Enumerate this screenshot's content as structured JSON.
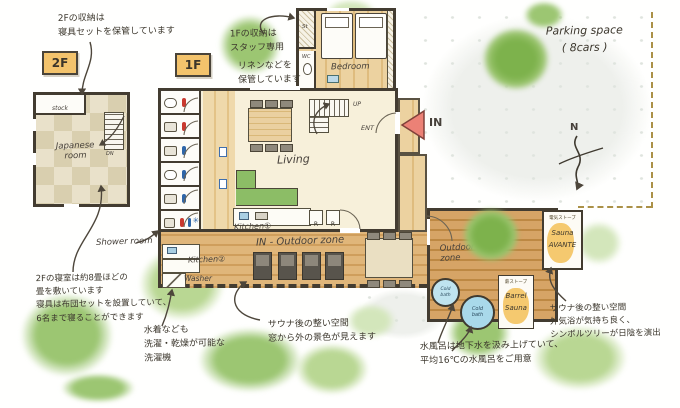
{
  "colors": {
    "wall": "#433c31",
    "ink": "#3c372d",
    "wood": "#dfbc7e",
    "deck": "#cf9e5c",
    "tatami_a": "#e9e1ca",
    "tatami_b": "#d9cfaf",
    "tag_orange": "#f3c36c",
    "sauna_orange": "#f5c96f",
    "tree_green": "#7db24c",
    "sofa_green": "#8cbd66",
    "cold_bath_blue": "#a9d9ea",
    "in_arrow_red": "#ec8176",
    "boundary_dash": "#ab9147"
  },
  "floor_tags": {
    "f2": "2F",
    "f1": "1F"
  },
  "plan2f": {
    "stock": "stock",
    "stairs_dn": "DN",
    "japanese_room": "Japanese\nroom"
  },
  "plan1f": {
    "st": "St",
    "wc": "WC",
    "bedroom": "Bedroom",
    "up": "UP",
    "ent": "ENT",
    "living": "Living",
    "kitchen1": "Kitchen①",
    "kitchen2": "Kitchen②",
    "washer": "Washer",
    "shower_room": "Shower room",
    "fridge": "R",
    "in_outdoor_zone": "IN - Outdoor zone",
    "in_arrow": "IN"
  },
  "outdoor": {
    "zone": "Outdoor\nzone",
    "cold_bath": "Cold\nbath",
    "barrel_heater": "薪ストーブ",
    "barrel_name": "Barrel\nSauna",
    "avante_heater": "電気ストーブ",
    "avante_name": "Sauna\nAVANTE"
  },
  "site": {
    "parking": "Parking space\n( 8cars )",
    "north": "N"
  },
  "annotations": {
    "storage_2f": "2Fの収納は\n寝具セットを保管しています",
    "storage_1f": "1Fの収納は\nスタッフ専用",
    "linen_1f": "リネンなどを\n保管しています",
    "bedroom_2f": "2Fの寝室は約8畳ほどの\n畳を敷いています\n寝具は布団セットを設置していて、\n6名まで寝ることができます",
    "washer_note": "水着なども\n洗濯・乾燥が可能な\n洗濯機",
    "deck_note": "サウナ後の整い空間\n窓から外の景色が見えます",
    "coldbath_note": "水風呂は地下水を汲み上げていて、\n平均16℃の水風呂をご用意",
    "outdoor_note": "サウナ後の整い空間\n外気浴が気持ち良く、\nシンボルツリーが日陰を演出"
  }
}
